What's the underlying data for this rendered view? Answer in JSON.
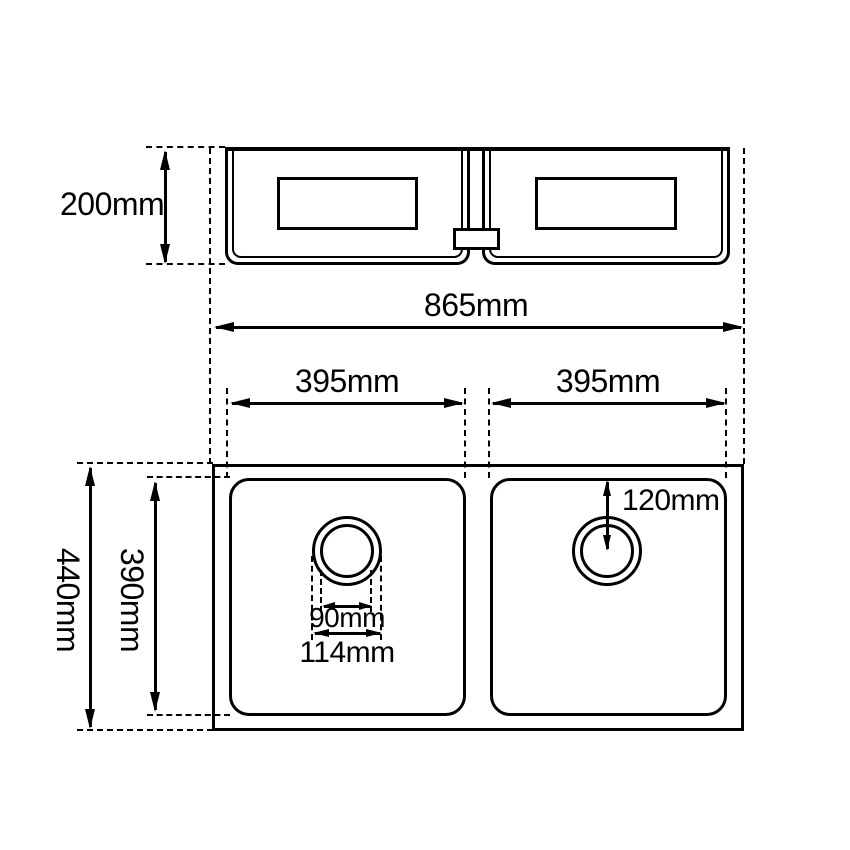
{
  "colors": {
    "line": "#000000",
    "background": "#ffffff"
  },
  "dims": {
    "height": "200mm",
    "overall_width": "865mm",
    "left_bowl_width": "395mm",
    "right_bowl_width": "395mm",
    "overall_depth": "440mm",
    "inner_depth": "390mm",
    "drain_offset": "120mm",
    "drain_hole": "90mm",
    "drain_flange": "114mm"
  }
}
